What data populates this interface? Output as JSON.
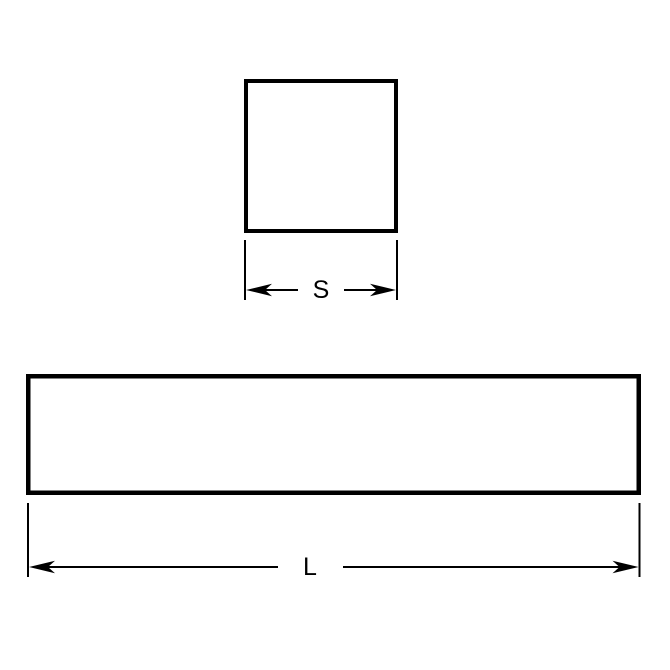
{
  "page": {
    "background_color": "#ffffff"
  },
  "diagram": {
    "kind": "dimensioned line drawing",
    "line_color": "#000000",
    "square": {
      "dimension_label": "S"
    },
    "bar": {
      "dimension_label": "L"
    }
  }
}
